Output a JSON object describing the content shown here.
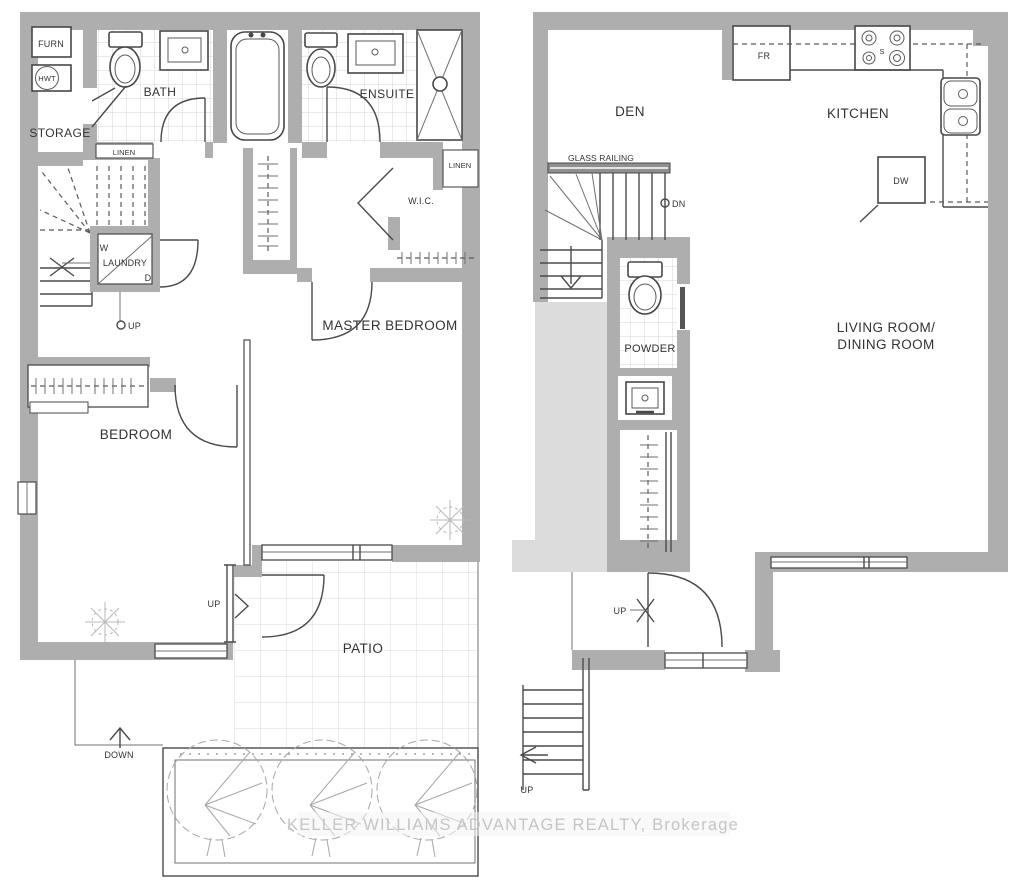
{
  "watermark": "KELLER WILLIAMS ADVANTAGE REALTY, Brokerage",
  "left_plan": {
    "furn": "FURN",
    "hwt": "HWT",
    "storage": "STORAGE",
    "bath": "BATH",
    "linen_bath": "LINEN",
    "ensuite": "ENSUITE",
    "linen_wic": "LINEN",
    "wic": "W.I.C.",
    "washer": "W",
    "laundry": "LAUNDRY",
    "dryer": "D",
    "up_stairs": "UP",
    "master_bedroom": "MASTER BEDROOM",
    "bedroom": "BEDROOM",
    "up_patio": "UP",
    "patio": "PATIO",
    "down": "DOWN"
  },
  "right_plan": {
    "den": "DEN",
    "fridge": "FR",
    "stove": "S",
    "kitchen": "KITCHEN",
    "dishwasher": "DW",
    "glass_railing": "GLASS RAILING",
    "dn": "DN",
    "powder": "POWDER",
    "living_line1": "LIVING ROOM/",
    "living_line2": "DINING ROOM",
    "up_entry": "UP",
    "up_exterior": "UP"
  },
  "colors": {
    "wall": "#aeaeae",
    "outline": "#4a4a4a",
    "tile_line": "#d6d6d6",
    "shade": "#dcdcdc",
    "watermark_text": "#c5c5c5",
    "paper": "#ffffff"
  }
}
